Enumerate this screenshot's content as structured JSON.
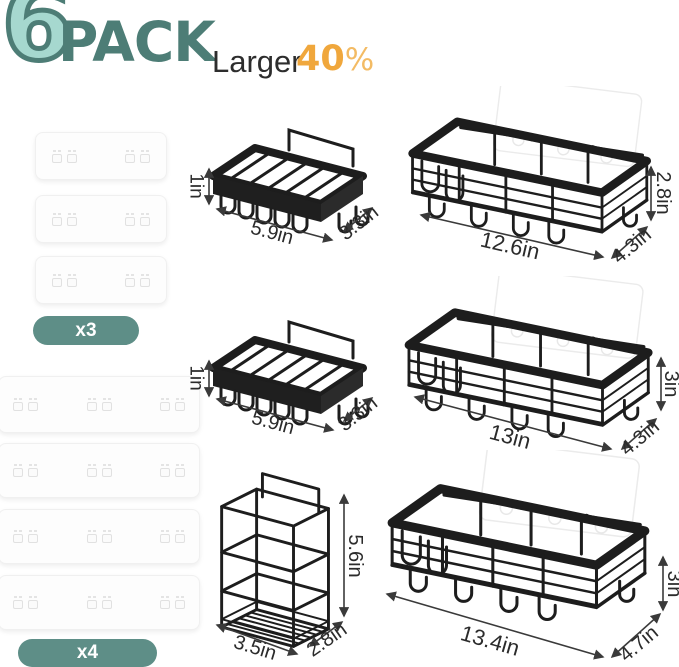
{
  "header": {
    "count": "6",
    "pack": "PACK",
    "larger": "Larger",
    "percent_value": "40",
    "percent_sign": "%"
  },
  "colors": {
    "teal_fill": "#a6d8cf",
    "teal_dark": "#4d7d76",
    "badge_teal": "#5e8e87",
    "orange": "#f0a73c",
    "wire_black": "#1d1d1d",
    "label_ink": "#2b2b2b"
  },
  "adhesive_pads": {
    "small": {
      "badge": "x3",
      "quantity": 3
    },
    "large": {
      "badge": "x4",
      "quantity": 4
    }
  },
  "items": {
    "soap_dish_top": {
      "label_height": "1in",
      "label_width": "5.9in",
      "label_depth": "3.3in"
    },
    "caddy_top": {
      "label_width": "12.6in",
      "label_height": "2.8in",
      "label_depth": "4.3in"
    },
    "soap_dish_mid": {
      "label_height": "1in",
      "label_width": "5.9in",
      "label_depth": "3.3in"
    },
    "caddy_mid": {
      "label_width": "13in",
      "label_height": "3in",
      "label_depth": "4.3in"
    },
    "toothbrush_holder": {
      "label_width": "3.5in",
      "label_depth": "2.8in",
      "label_height": "5.6in"
    },
    "caddy_bottom": {
      "label_width": "13.4in",
      "label_height": "3in",
      "label_depth": "4.7in"
    }
  }
}
